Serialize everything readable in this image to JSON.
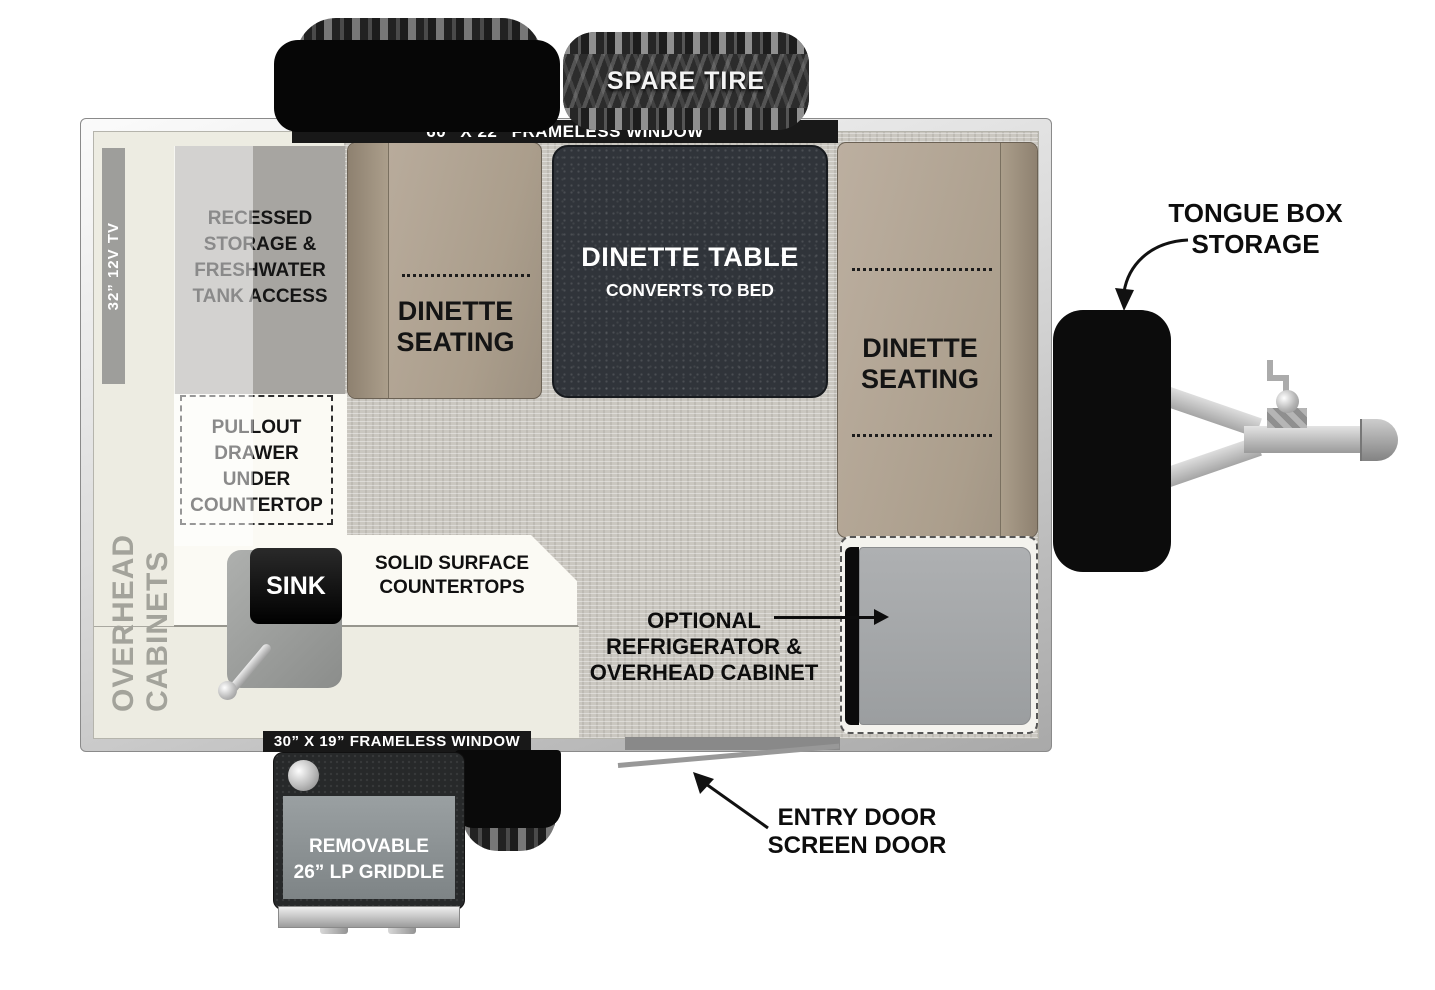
{
  "labels": {
    "spare_tire": "SPARE TIRE",
    "window_top": "60” X 22” FRAMELESS WINDOW",
    "window_bottom": "30” X 19” FRAMELESS WINDOW",
    "tv": "32” 12V TV",
    "overhead_cabinets": "OVERHEAD CABINETS",
    "recessed_storage": [
      "RECESSED",
      "STORAGE &",
      "FRESHWATER",
      "TANK ACCESS"
    ],
    "pullout_drawer": [
      "PULLOUT",
      "DRAWER",
      "UNDER",
      "COUNTERTOP"
    ],
    "dinette_seating": [
      "DINETTE",
      "SEATING"
    ],
    "dinette_table": [
      "DINETTE TABLE",
      "CONVERTS TO BED"
    ],
    "sink": "SINK",
    "countertops": [
      "SOLID SURFACE",
      "COUNTERTOPS"
    ],
    "refrigerator": [
      "OPTIONAL",
      "REFRIGERATOR &",
      "OVERHEAD CABINET"
    ],
    "entry_door": [
      "ENTRY DOOR",
      "SCREEN DOOR"
    ],
    "tongue_box": [
      "TONGUE BOX",
      "STORAGE"
    ],
    "griddle": [
      "REMOVABLE",
      "26” LP GRIDDLE"
    ]
  },
  "colors": {
    "seat_tan": "#b3a694",
    "table_dark": "#30343a",
    "floor_gray": "#cac7c0",
    "cabinet_cream": "#edece2",
    "label_bar_black": "#181818",
    "fridge_gray": "#a6a8aa"
  }
}
